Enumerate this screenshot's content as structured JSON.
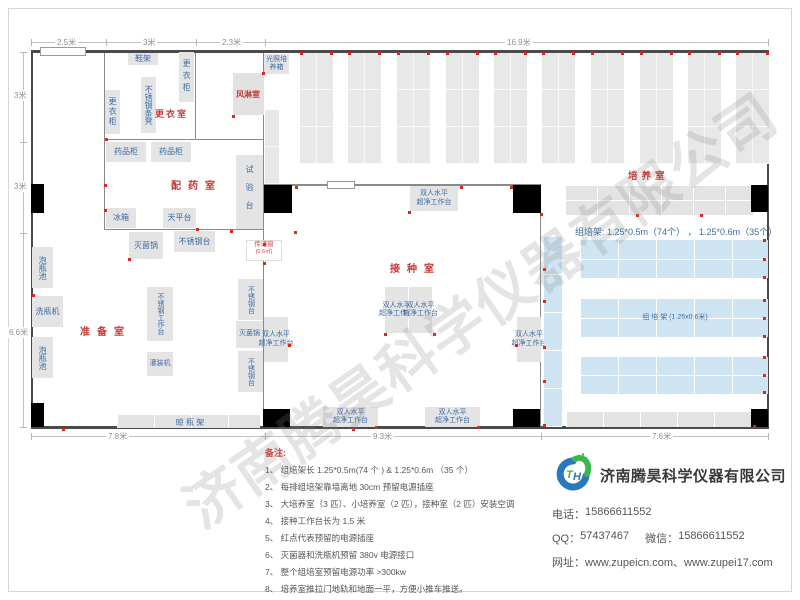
{
  "watermark": "济南腾昊科学仪器有限公司",
  "dims": {
    "top": [
      "2.5米",
      "3米",
      "2.3米",
      "16.9米"
    ],
    "left": [
      "3米",
      "3米",
      "6.6米"
    ],
    "bottom": [
      "7.8米",
      "9.3米",
      "7.6米"
    ]
  },
  "rooms": {
    "changing": "更衣室",
    "air_shower": "风淋室",
    "dispensing": "配药室",
    "prep": "准备室",
    "inoculation": "接种室",
    "culture": "培养室"
  },
  "equipment": {
    "shoe_rack": "鞋架",
    "locker": "更衣柜",
    "steel_bench": "不锈钢条凳",
    "light_incubator": "光照培养箱",
    "medicine_cabinet": "药品柜",
    "test_bench": "试验台",
    "fridge": "冰箱",
    "balance_table": "天平台",
    "sterilizer": "灭菌锅",
    "steel_table": "不锈钢台",
    "steel_worktable": "不锈钢工作台",
    "filling_machine": "灌装机",
    "bottle_pool": "泡瓶池",
    "bottle_washer": "洗瓶机",
    "drying_rack": "晾 瓶 架",
    "clean_bench_line1": "双人水平",
    "clean_bench_line2": "超净工作台",
    "pass_window": "传递窗",
    "pass_window_size": "(0.6㎡)",
    "rack_v_label": "组培架",
    "rack_v_size": "(1.25x0.5米)",
    "rack_h_label": "组 培 架 (1.25x0.6米)"
  },
  "culture_spec": "组培架: 1.25*0.5m（74个） ， 1.25*0.6m（35个）",
  "notes": {
    "title": "备注:",
    "items": [
      "1、 组培架长 1.25*0.5m(74 个 ) & 1.25*0.6m （35 个）",
      "2、 每排组培架靠墙离地 30cm 预留电源插座",
      "3、 大培养室（3 匹）、小培养室（2 匹），接种室（2 匹）安装空调",
      "4、 接种工作台长为 1.5 米",
      "5、 红点代表预留的电源插座",
      "6、 灭菌器和洗瓶机预留 380v 电源接口",
      "7、 整个组培室预留电源功率 >300kw",
      "8、 培养室推拉门地轨和地面一平，方便小推车推送。"
    ]
  },
  "company": {
    "name": "济南腾昊科学仪器有限公司",
    "logo_monogram": "TH",
    "phone_label": "电话：",
    "phone": "15866611552",
    "qq_label": "QQ：",
    "qq": "57437467",
    "wechat_label": "微信：",
    "wechat": "15866611552",
    "web_label": "网址：",
    "websites": "www.zupeicn.com、www.zupei17.com"
  }
}
